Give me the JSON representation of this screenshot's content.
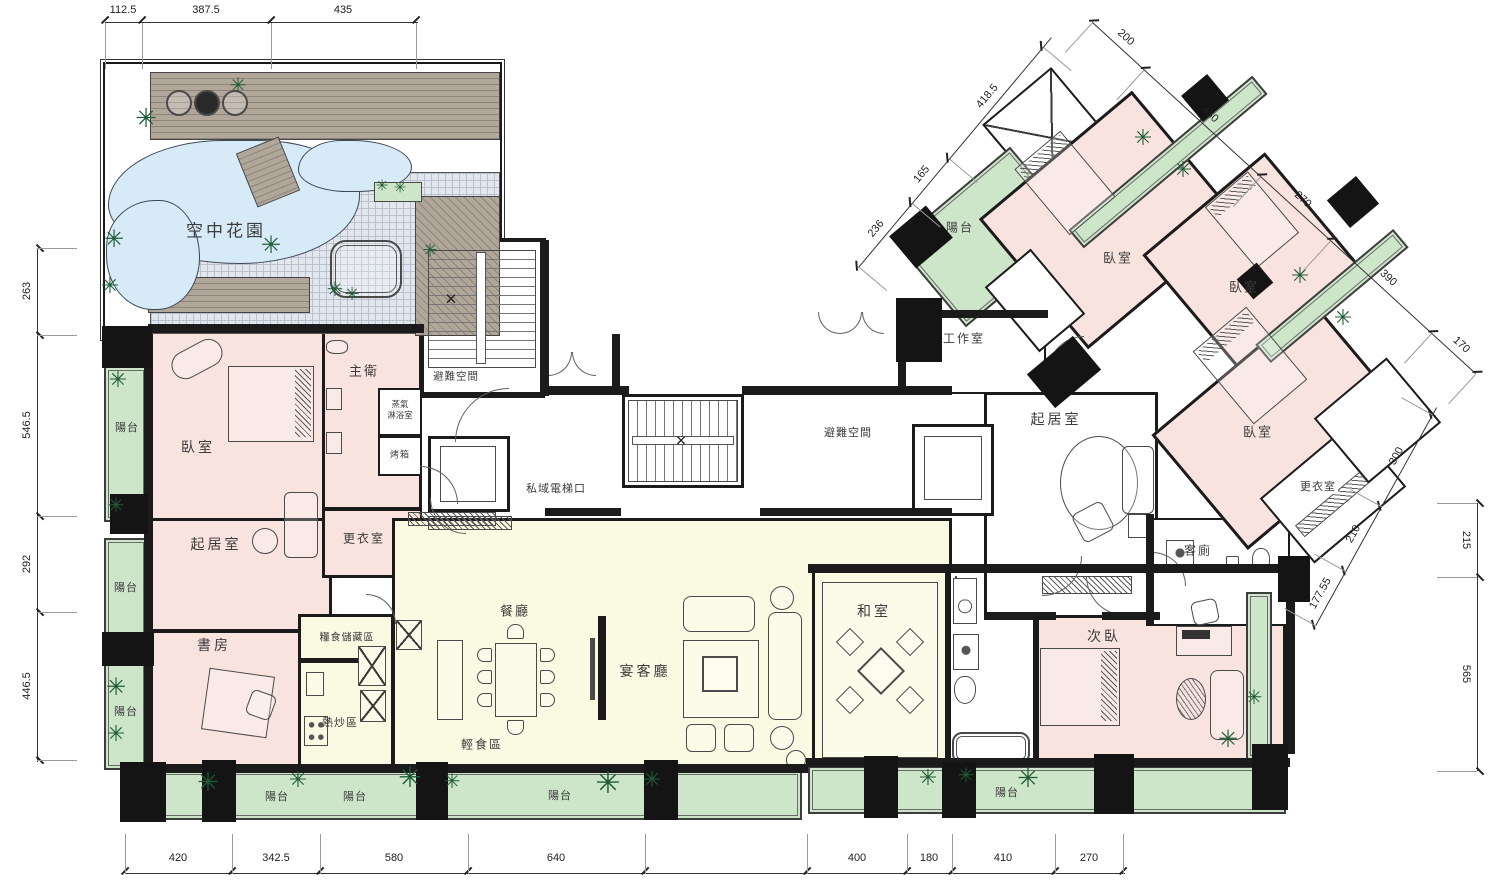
{
  "colors": {
    "wall": "#1b1b1b",
    "room_pink": "#f8e3df",
    "area_yellow": "#fafae3",
    "balcony_green": "#cde5c9",
    "pond_blue": "#d6eaf7",
    "tile_gray": "#e2e6ed",
    "deck_taupe": "#b0a699",
    "plant_green": "#1f5c36"
  },
  "rooms": {
    "sky_garden": "空中花園",
    "master_bath": "主衛",
    "steam_shower_lines": [
      "蒸氣",
      "淋浴室"
    ],
    "oven": "烤箱",
    "refuge_left": "避難空間",
    "refuge_right": "避難空間",
    "private_elevator": "私域電梯口",
    "master_bedroom": "臥室",
    "living_left": "起居室",
    "dressing_left": "更衣室",
    "study": "書房",
    "pantry": "糧食儲藏區",
    "wok_area": "熱炒區",
    "light_meal": "輕食區",
    "dining": "餐廳",
    "banquet": "宴客廳",
    "tatami": "和室",
    "workroom": "工作室",
    "living_right": "起居室",
    "bedroom_wing_a": "臥室",
    "bedroom_wing_b": "臥室",
    "bedroom_wing_c": "臥室",
    "dressing_wing": "更衣室",
    "guest_toilet": "客廁",
    "second_bedroom": "次臥",
    "balcony": "陽台"
  },
  "dimensions": {
    "top": [
      "112.5",
      "387.5",
      "435"
    ],
    "left": [
      "263",
      "546.5",
      "292",
      "446.5"
    ],
    "bottom": [
      "420",
      "342.5",
      "580",
      "640",
      "400",
      "180",
      "410",
      "270"
    ],
    "right": [
      "215",
      "565"
    ],
    "wing_outer": [
      "200",
      "450",
      "270",
      "390",
      "170"
    ],
    "wing_inner": [
      "236",
      "165",
      "418.5"
    ],
    "wing_right": [
      "177.55",
      "210",
      "300"
    ]
  }
}
